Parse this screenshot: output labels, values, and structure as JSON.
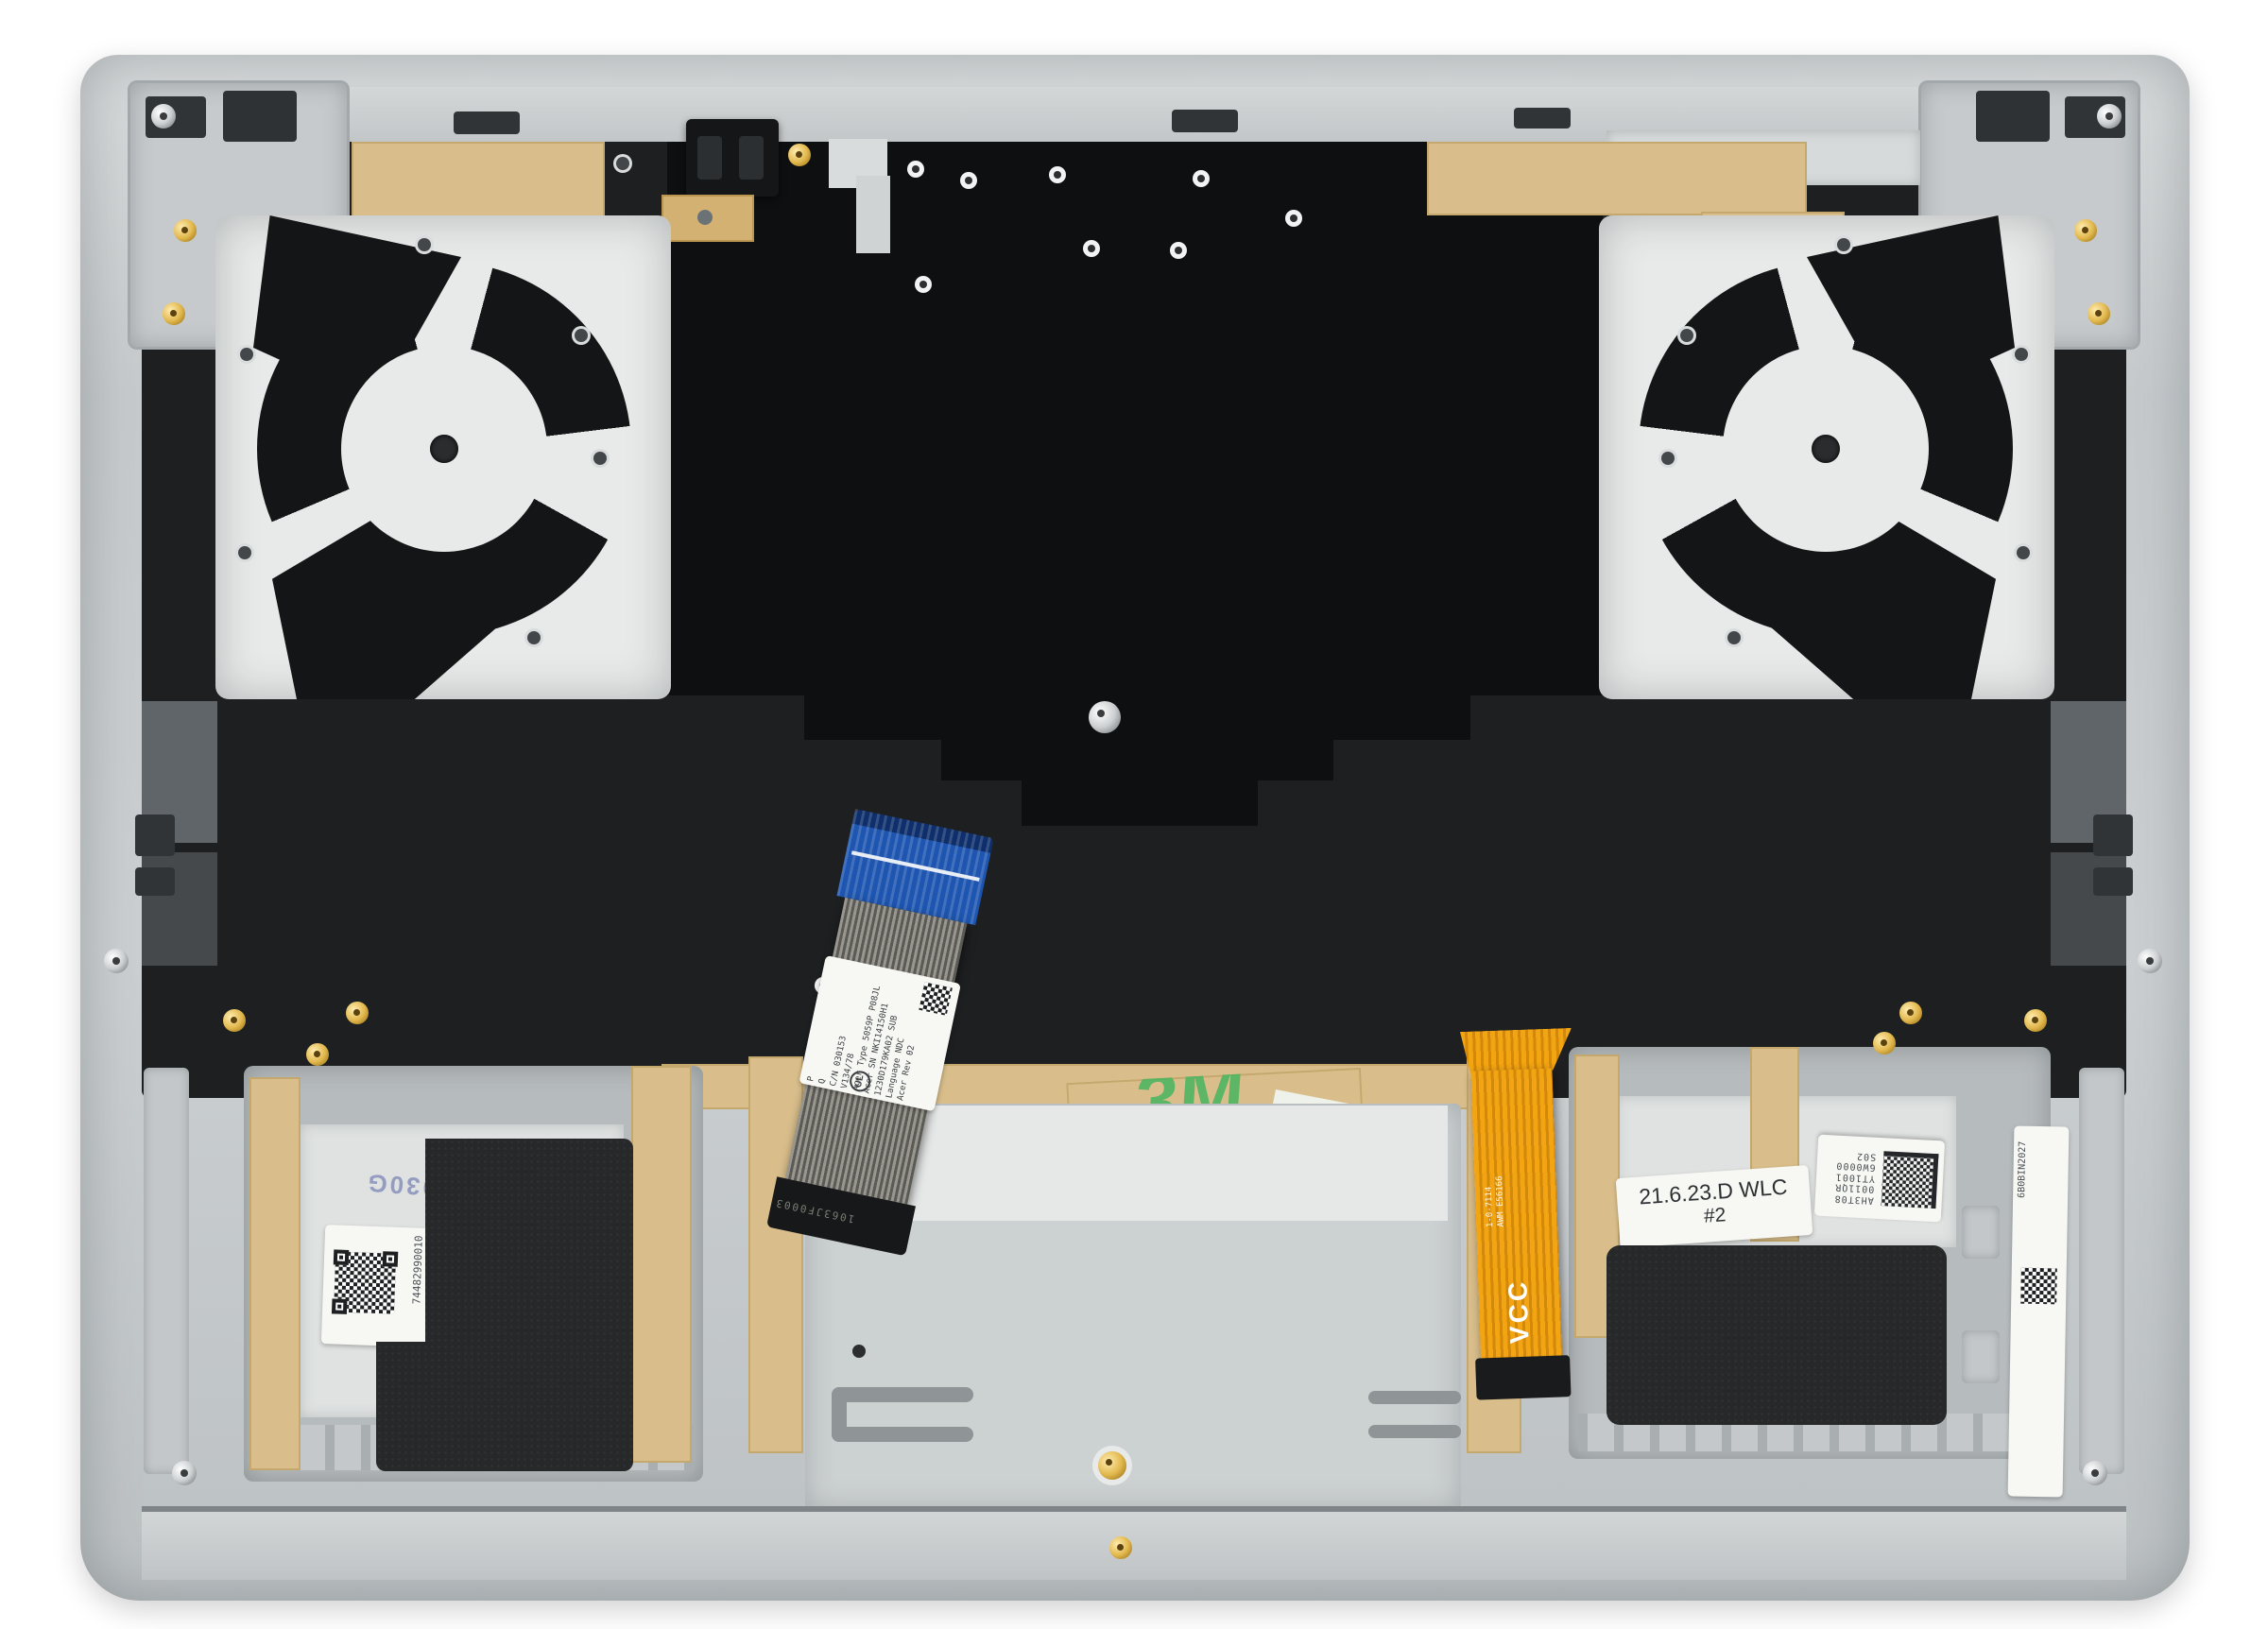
{
  "photo": {
    "subject": "laptop top-case palmrest internal side with dual fan plates, keyboard shield, flex cables and speaker modules",
    "colors": {
      "backdrop": "#ffffff",
      "chassis_silver": "#c8ccce",
      "keyboard_plate": "#e8eae9",
      "mylar_black": "#0e0f10",
      "kapton_tan": "#d9be8b",
      "ffc_blue": "#1d55b0",
      "ffc_orange": "#f09d10",
      "foam_black": "#27282a",
      "stamp_ink_blue": "#7b85b5",
      "tape_logo_green": "#46b55e"
    },
    "labels": {
      "hinge_stamp": "M2x4.5",
      "kb": {
        "lines": [
          "Acer Type 5059P P08JL",
          "Acer SN NKI14150H1",
          "1230D179KA02 SUB",
          "Language NDC",
          "Acer Rev 02"
        ],
        "cn": "C/N 030153",
        "ver": "V134/78",
        "p": "P",
        "q": "Q",
        "cert": "UL"
      },
      "ribbon_marking": "1063JF0003",
      "orange": {
        "vcc": "VCC",
        "m1": "1-0-7114",
        "m2": "AWM E56166"
      },
      "tape3m": "3M",
      "stamp_blue": "41Y030G",
      "qr_left_serial": "74482990010",
      "wlc": {
        "l1": "21.6.23.D WLC",
        "l2": "#2"
      },
      "qr_right": {
        "l1": "AH3T08",
        "l2": "0011QR",
        "l3": "YT1001",
        "l4": "6W0000",
        "l5": "S02"
      },
      "side_serial": "6B0BIN2027"
    }
  }
}
